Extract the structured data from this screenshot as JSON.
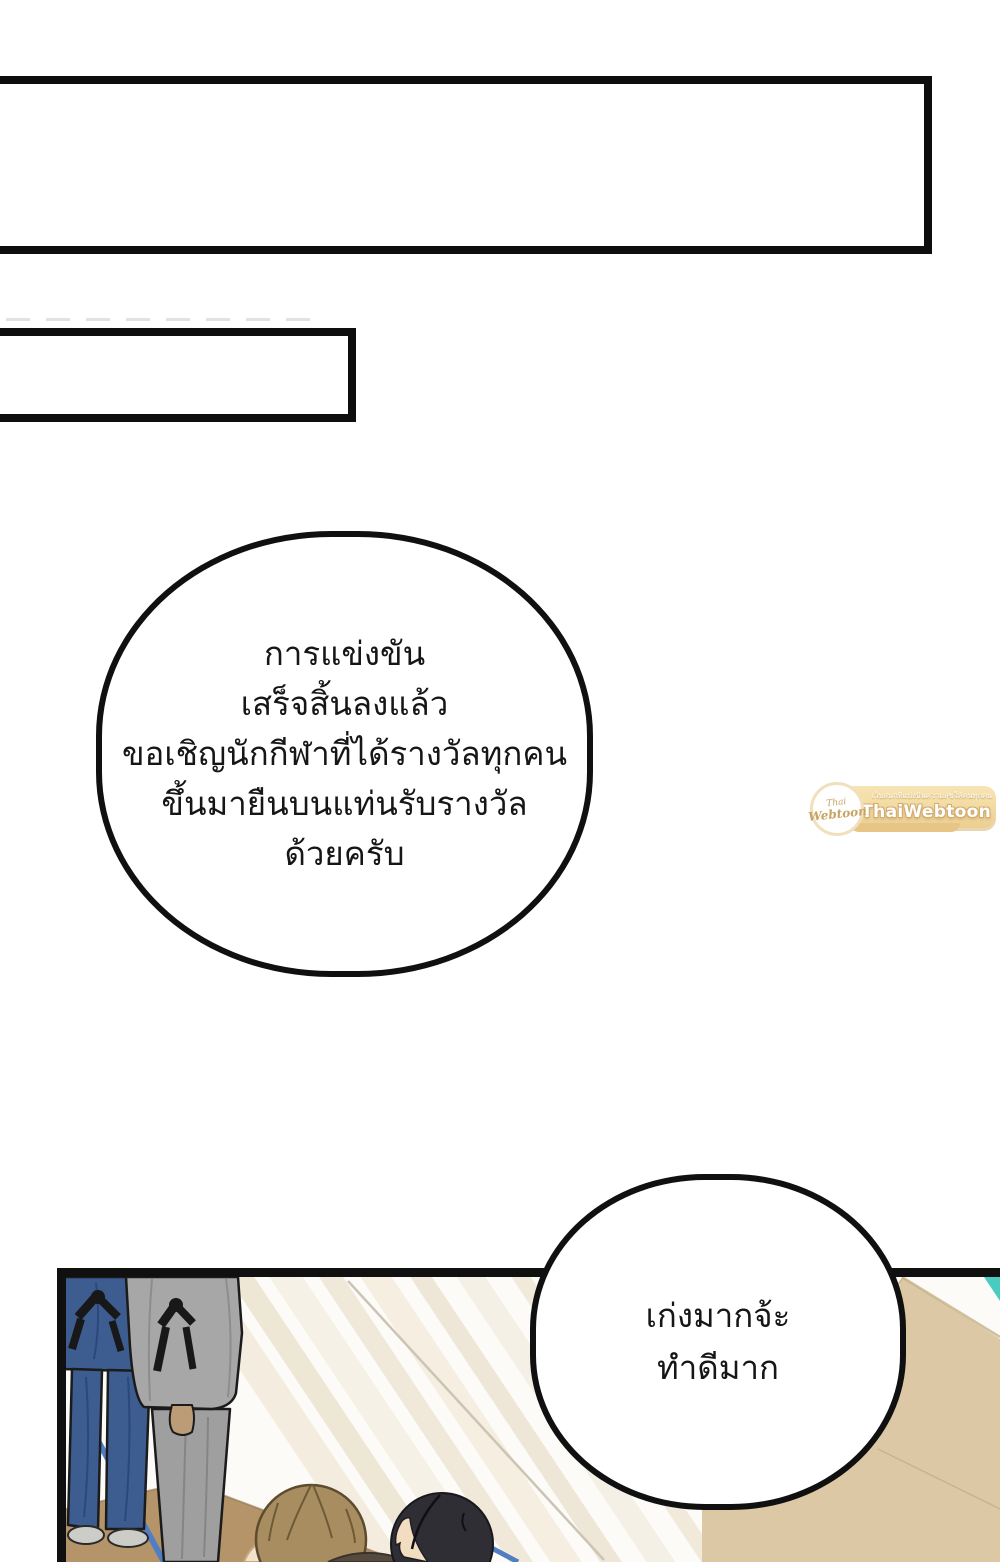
{
  "page": {
    "kind": "webtoon comic page",
    "background_color": "#ffffff"
  },
  "caption_boxes": {
    "box1": {
      "text": ""
    },
    "box2": {
      "text": ""
    }
  },
  "speech_bubbles": {
    "announcer": {
      "lines": [
        "การแข่งขัน",
        "เสร็จสิ้นลงแล้ว",
        "ขอเชิญนักกีฬาที่ได้รางวัลทุกคน",
        "ขึ้นมายืนบนแท่นรับรางวัล",
        "ด้วยครับ"
      ]
    },
    "praise": {
      "lines": [
        "เก่งมากจ้ะ",
        "ทำดีมาก"
      ]
    }
  },
  "watermark": {
    "brand": "ThaiWebtoon",
    "tagline": "เว็บสนุกที่แบ่งปันความสุขให้คนทุกคน",
    "logo_script_top": "Thai",
    "logo_script_bottom": "Webtoon",
    "banner_color": "#f2d99e",
    "text_color": "#ffffff"
  },
  "scene": {
    "description_colors": {
      "outline": "#101010",
      "blue_uniform": "#3d5c8f",
      "gray_uniform": "#a7a7a7",
      "belt_black": "#181818",
      "beige_wall": "#dcc8a5",
      "teal_accent": "#49cbc2",
      "floor_brown": "#b49468",
      "floor_line_blue": "#4f7fc2",
      "hair_brown": "#a88d60",
      "hair_black": "#2e2e34",
      "skin": "#f3ddc0",
      "shoe_gray": "#cdcdc8"
    }
  }
}
